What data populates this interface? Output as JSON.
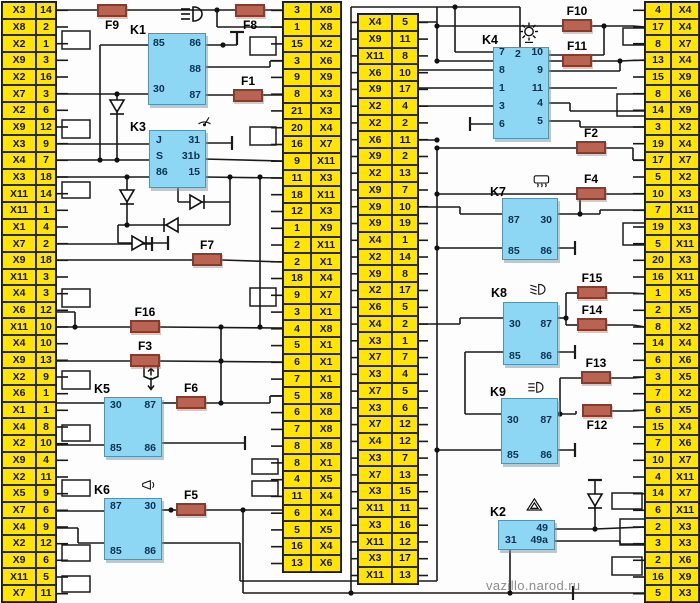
{
  "watermark": "vazillo.narod.ru",
  "colors": {
    "connector_bg": "#ffe405",
    "relay_bg": "#8ed7f4",
    "fuse_bg": "#b96352",
    "wire": "#1a1a1a"
  },
  "columns": {
    "left": {
      "rows": [
        [
          "X3",
          "14"
        ],
        [
          "X8",
          "2"
        ],
        [
          "X2",
          "1"
        ],
        [
          "X9",
          "3"
        ],
        [
          "X2",
          "16"
        ],
        [
          "X7",
          "3"
        ],
        [
          "X2",
          "6"
        ],
        [
          "X9",
          "12"
        ],
        [
          "X3",
          "9"
        ],
        [
          "X4",
          "7"
        ],
        [
          "X3",
          "18"
        ],
        [
          "X11",
          "14"
        ],
        [
          "X11",
          "1"
        ],
        [
          "X1",
          "4"
        ],
        [
          "X7",
          "2"
        ],
        [
          "X9",
          "18"
        ],
        [
          "X11",
          "3"
        ],
        [
          "X4",
          "3"
        ],
        [
          "X6",
          "12"
        ],
        [
          "X11",
          "10"
        ],
        [
          "X4",
          "10"
        ],
        [
          "X9",
          "13"
        ],
        [
          "X2",
          "9"
        ],
        [
          "X6",
          "1"
        ],
        [
          "X1",
          "1"
        ],
        [
          "X4",
          "8"
        ],
        [
          "X2",
          "10"
        ],
        [
          "X9",
          "4"
        ],
        [
          "X2",
          "11"
        ],
        [
          "X5",
          "9"
        ],
        [
          "X7",
          "6"
        ],
        [
          "X4",
          "9"
        ],
        [
          "X2",
          "12"
        ],
        [
          "X9",
          "6"
        ],
        [
          "X11",
          "5"
        ],
        [
          "X7",
          "11"
        ]
      ]
    },
    "mid_left": {
      "rows": [
        [
          "3",
          "X8"
        ],
        [
          "1",
          "X8"
        ],
        [
          "15",
          "X2"
        ],
        [
          "3",
          "X6"
        ],
        [
          "9",
          "X9"
        ],
        [
          "8",
          "X3"
        ],
        [
          "21",
          "X3"
        ],
        [
          "20",
          "X4"
        ],
        [
          "16",
          "X7"
        ],
        [
          "9",
          "X11"
        ],
        [
          "11",
          "X3"
        ],
        [
          "18",
          "X11"
        ],
        [
          "12",
          "X3"
        ],
        [
          "1",
          "X9"
        ],
        [
          "2",
          "X11"
        ],
        [
          "2",
          "X1"
        ],
        [
          "18",
          "X4"
        ],
        [
          "9",
          "X7"
        ],
        [
          "3",
          "X1"
        ],
        [
          "4",
          "X8"
        ],
        [
          "5",
          "X1"
        ],
        [
          "6",
          "X1"
        ],
        [
          "7",
          "X1"
        ],
        [
          "5",
          "X8"
        ],
        [
          "6",
          "X8"
        ],
        [
          "7",
          "X8"
        ],
        [
          "8",
          "X8"
        ],
        [
          "8",
          "X1"
        ],
        [
          "4",
          "X5"
        ],
        [
          "11",
          "X4"
        ],
        [
          "6",
          "X4"
        ],
        [
          "5",
          "X5"
        ],
        [
          "16",
          "X4"
        ],
        [
          "13",
          "X6"
        ]
      ]
    },
    "mid_right": {
      "rows": [
        [
          "X4",
          "5"
        ],
        [
          "X9",
          "11"
        ],
        [
          "X11",
          "8"
        ],
        [
          "X6",
          "10"
        ],
        [
          "X9",
          "17"
        ],
        [
          "X2",
          "4"
        ],
        [
          "X2",
          "2"
        ],
        [
          "X6",
          "11"
        ],
        [
          "X9",
          "2"
        ],
        [
          "X2",
          "13"
        ],
        [
          "X9",
          "7"
        ],
        [
          "X9",
          "10"
        ],
        [
          "X9",
          "19"
        ],
        [
          "X4",
          "1"
        ],
        [
          "X2",
          "14"
        ],
        [
          "X9",
          "8"
        ],
        [
          "X2",
          "17"
        ],
        [
          "X6",
          "5"
        ],
        [
          "X4",
          "2"
        ],
        [
          "X3",
          "1"
        ],
        [
          "X7",
          "7"
        ],
        [
          "X3",
          "4"
        ],
        [
          "X7",
          "5"
        ],
        [
          "X3",
          "6"
        ],
        [
          "X7",
          "12"
        ],
        [
          "X4",
          "12"
        ],
        [
          "X3",
          "7"
        ],
        [
          "X7",
          "13"
        ],
        [
          "X3",
          "15"
        ],
        [
          "X11",
          "11"
        ],
        [
          "X3",
          "16"
        ],
        [
          "X11",
          "12"
        ],
        [
          "X3",
          "17"
        ],
        [
          "X11",
          "13"
        ]
      ]
    },
    "right": {
      "rows": [
        [
          "4",
          "X4"
        ],
        [
          "17",
          "X4"
        ],
        [
          "8",
          "X7"
        ],
        [
          "13",
          "X4"
        ],
        [
          "15",
          "X9"
        ],
        [
          "8",
          "X6"
        ],
        [
          "14",
          "X9"
        ],
        [
          "3",
          "X2"
        ],
        [
          "19",
          "X4"
        ],
        [
          "17",
          "X7"
        ],
        [
          "5",
          "X2"
        ],
        [
          "10",
          "X3"
        ],
        [
          "7",
          "X11"
        ],
        [
          "19",
          "X3"
        ],
        [
          "5",
          "X11"
        ],
        [
          "20",
          "X3"
        ],
        [
          "16",
          "X11"
        ],
        [
          "1",
          "X5"
        ],
        [
          "2",
          "X5"
        ],
        [
          "8",
          "X2"
        ],
        [
          "14",
          "X4"
        ],
        [
          "6",
          "X6"
        ],
        [
          "3",
          "X5"
        ],
        [
          "7",
          "X2"
        ],
        [
          "6",
          "X5"
        ],
        [
          "15",
          "X4"
        ],
        [
          "7",
          "X6"
        ],
        [
          "10",
          "X7"
        ],
        [
          "4",
          "X11"
        ],
        [
          "14",
          "X7"
        ],
        [
          "6",
          "X11"
        ],
        [
          "2",
          "X3"
        ],
        [
          "3",
          "X3"
        ],
        [
          "2",
          "X6"
        ],
        [
          "16",
          "X9"
        ],
        [
          "5",
          "X3"
        ]
      ]
    }
  },
  "relays": [
    {
      "id": "K1",
      "icon": "high-beam",
      "pins": {
        "tl": "85",
        "tr": "86",
        "mr": "88",
        "bl": "30",
        "br": "87"
      }
    },
    {
      "id": "K3",
      "icon": "wiper",
      "rows": [
        [
          "J",
          "31"
        ],
        [
          "S",
          "31b"
        ],
        [
          "86",
          "15"
        ]
      ]
    },
    {
      "id": "K5",
      "icon": "power-window",
      "pins": {
        "tl": "30",
        "tr": "87",
        "bl": "85",
        "br": "86"
      }
    },
    {
      "id": "K6",
      "icon": "horn",
      "pins": {
        "tl": "87",
        "tr": "30",
        "bl": "85",
        "br": "86"
      }
    },
    {
      "id": "K4",
      "icon": "turn-flasher",
      "top_pin": "2",
      "left_pins": [
        "7",
        "8",
        "1",
        "3",
        "6"
      ],
      "right_pins": [
        "10",
        "9",
        "11",
        "4",
        "5"
      ]
    },
    {
      "id": "K7",
      "icon": "heated-rear-window",
      "pins": {
        "tl": "87",
        "tr": "30",
        "bl": "85",
        "br": "86"
      }
    },
    {
      "id": "K8",
      "icon": "low-beam",
      "pins": {
        "tl": "30",
        "tr": "87",
        "bl": "85",
        "br": "86"
      }
    },
    {
      "id": "K9",
      "icon": "high-beam",
      "pins": {
        "tl": "30",
        "tr": "87",
        "bl": "85",
        "br": "86"
      }
    },
    {
      "id": "K2",
      "icon": "hazard",
      "pins": {
        "tr": "49",
        "bl": "31",
        "br": "49a"
      }
    }
  ],
  "fuses": [
    "F9",
    "F8",
    "F1",
    "F7",
    "F16",
    "F3",
    "F6",
    "F5",
    "F10",
    "F11",
    "F2",
    "F4",
    "F15",
    "F14",
    "F13",
    "F12"
  ]
}
